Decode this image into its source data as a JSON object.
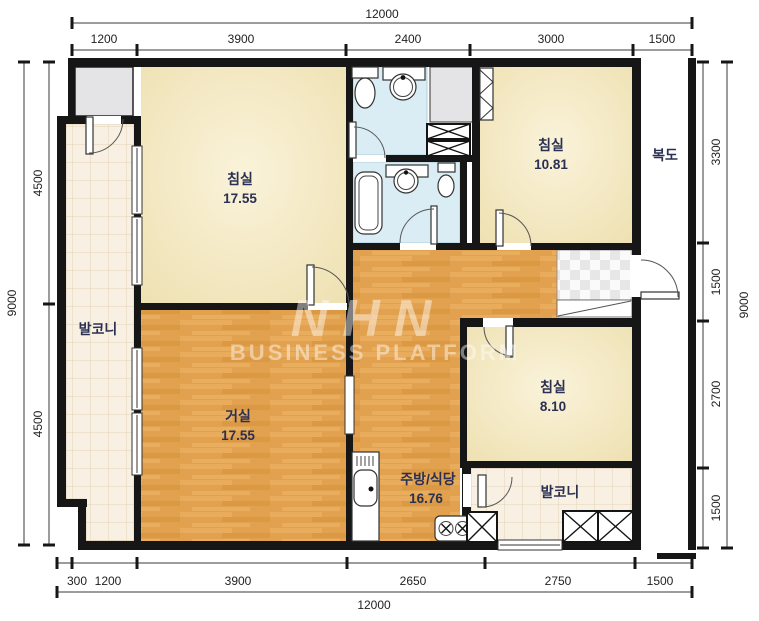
{
  "plan": {
    "watermark": {
      "logo": "NHN",
      "text": "BUSINESS PLATFORM"
    },
    "rooms": {
      "bedroom1": {
        "name": "침실",
        "area": "17.55"
      },
      "bedroom2": {
        "name": "침실",
        "area": "10.81"
      },
      "bedroom3": {
        "name": "침실",
        "area": "8.10"
      },
      "living": {
        "name": "거실",
        "area": "17.55"
      },
      "kitchen": {
        "name": "주방/식당",
        "area": "16.76"
      },
      "balcony_left": {
        "name": "발코니"
      },
      "balcony_right": {
        "name": "발코니"
      },
      "corridor": {
        "name": "복도"
      }
    },
    "dimensions": {
      "top_total": "12000",
      "top": [
        "1200",
        "3900",
        "2400",
        "3000",
        "1500"
      ],
      "right": [
        "3300",
        "1500",
        "2700",
        "1500"
      ],
      "right_total": "9000",
      "bottom": [
        "300",
        "1200",
        "3900",
        "2650",
        "2750",
        "1500"
      ],
      "bottom_total": "12000",
      "left": [
        "4500",
        "4500"
      ],
      "left_total": "9000"
    },
    "colors": {
      "wall": "#161616",
      "room_cream": "#f3e8c2",
      "wood_floor": "#e2a14e",
      "balcony_tile": "#f8f0e3",
      "bathroom_blue": "#daedf4",
      "closet_gray": "#e4e4e7",
      "entry_checker": "#e7e7e7",
      "label_text": "#2a3052",
      "watermark": "#ffffff"
    }
  }
}
